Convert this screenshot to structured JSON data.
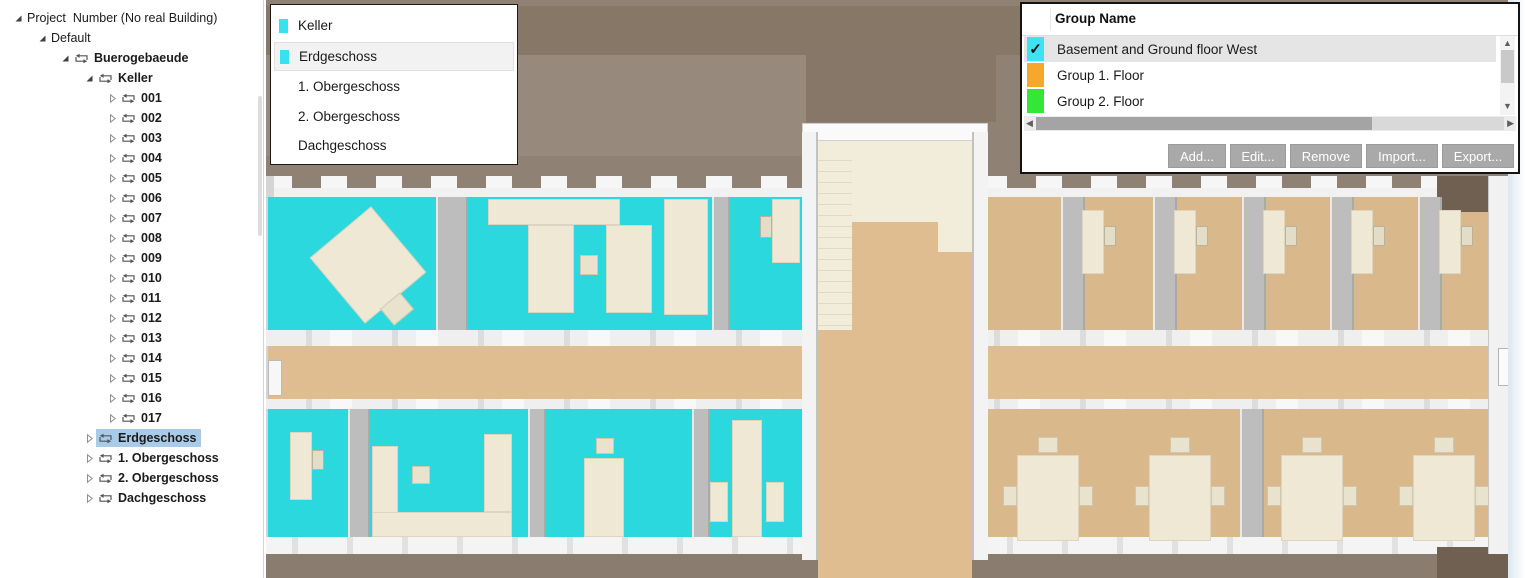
{
  "tree": {
    "items": [
      {
        "label": "Project  Number (No real Building)",
        "level": 0,
        "expanded": true,
        "swap": false,
        "bold": false,
        "selected": false
      },
      {
        "label": "Default",
        "level": 1,
        "expanded": true,
        "swap": false,
        "bold": false,
        "selected": false
      },
      {
        "label": "Buerogebaeude",
        "level": 2,
        "expanded": true,
        "swap": true,
        "bold": true,
        "selected": false
      },
      {
        "label": "Keller",
        "level": 3,
        "expanded": true,
        "swap": true,
        "bold": true,
        "selected": false
      },
      {
        "label": "001",
        "level": 4,
        "expanded": false,
        "swap": true,
        "bold": true,
        "selected": false
      },
      {
        "label": "002",
        "level": 4,
        "expanded": false,
        "swap": true,
        "bold": true,
        "selected": false
      },
      {
        "label": "003",
        "level": 4,
        "expanded": false,
        "swap": true,
        "bold": true,
        "selected": false
      },
      {
        "label": "004",
        "level": 4,
        "expanded": false,
        "swap": true,
        "bold": true,
        "selected": false
      },
      {
        "label": "005",
        "level": 4,
        "expanded": false,
        "swap": true,
        "bold": true,
        "selected": false
      },
      {
        "label": "006",
        "level": 4,
        "expanded": false,
        "swap": true,
        "bold": true,
        "selected": false
      },
      {
        "label": "007",
        "level": 4,
        "expanded": false,
        "swap": true,
        "bold": true,
        "selected": false
      },
      {
        "label": "008",
        "level": 4,
        "expanded": false,
        "swap": true,
        "bold": true,
        "selected": false
      },
      {
        "label": "009",
        "level": 4,
        "expanded": false,
        "swap": true,
        "bold": true,
        "selected": false
      },
      {
        "label": "010",
        "level": 4,
        "expanded": false,
        "swap": true,
        "bold": true,
        "selected": false
      },
      {
        "label": "011",
        "level": 4,
        "expanded": false,
        "swap": true,
        "bold": true,
        "selected": false
      },
      {
        "label": "012",
        "level": 4,
        "expanded": false,
        "swap": true,
        "bold": true,
        "selected": false
      },
      {
        "label": "013",
        "level": 4,
        "expanded": false,
        "swap": true,
        "bold": true,
        "selected": false
      },
      {
        "label": "014",
        "level": 4,
        "expanded": false,
        "swap": true,
        "bold": true,
        "selected": false
      },
      {
        "label": "015",
        "level": 4,
        "expanded": false,
        "swap": true,
        "bold": true,
        "selected": false
      },
      {
        "label": "016",
        "level": 4,
        "expanded": false,
        "swap": true,
        "bold": true,
        "selected": false
      },
      {
        "label": "017",
        "level": 4,
        "expanded": false,
        "swap": true,
        "bold": true,
        "selected": false
      },
      {
        "label": "Erdgeschoss",
        "level": 3,
        "expanded": false,
        "swap": true,
        "bold": true,
        "selected": true
      },
      {
        "label": "1. Obergeschoss",
        "level": 3,
        "expanded": false,
        "swap": true,
        "bold": true,
        "selected": false
      },
      {
        "label": "2. Obergeschoss",
        "level": 3,
        "expanded": false,
        "swap": true,
        "bold": true,
        "selected": false
      },
      {
        "label": "Dachgeschoss",
        "level": 3,
        "expanded": false,
        "swap": true,
        "bold": true,
        "selected": false
      }
    ]
  },
  "legend": {
    "items": [
      {
        "label": "Keller",
        "chip_color": "#38E1EF",
        "selected": false
      },
      {
        "label": "Erdgeschoss",
        "chip_color": "#38E1EF",
        "selected": true
      },
      {
        "label": "1. Obergeschoss",
        "chip_color": null,
        "selected": false
      },
      {
        "label": "2. Obergeschoss",
        "chip_color": null,
        "selected": false
      },
      {
        "label": "Dachgeschoss",
        "chip_color": null,
        "selected": false
      }
    ]
  },
  "groups": {
    "header": "Group Name",
    "items": [
      {
        "label": "Basement and Ground floor West",
        "color": "#3FE2F2",
        "checked": true,
        "selected": true
      },
      {
        "label": "Group 1. Floor",
        "color": "#F5A72E",
        "checked": false,
        "selected": false
      },
      {
        "label": "Group 2. Floor",
        "color": "#36E636",
        "checked": false,
        "selected": false
      }
    ],
    "check_glyph": "✓",
    "buttons": [
      {
        "id": "add",
        "label": "Add...",
        "width": 58
      },
      {
        "id": "edit",
        "label": "Edit...",
        "width": 56
      },
      {
        "id": "remove",
        "label": "Remove",
        "width": 72
      },
      {
        "id": "import",
        "label": "Import...",
        "width": 72
      },
      {
        "id": "export",
        "label": "Export...",
        "width": 72
      }
    ],
    "scroll_arrows": {
      "up": "▲",
      "down": "▼",
      "left": "◀",
      "right": "▶"
    }
  },
  "canvas": {
    "colors": {
      "background": "#8F8174",
      "band_dark": "#867767",
      "band_mid": "#97897B",
      "band_stair": "#877769",
      "exterior_bottom": "#8A7C6E",
      "exterior_dark": "#6F6051",
      "cyan_floor": "#2BD8DE",
      "tan_floor": "#D9B88C",
      "corridor": "#DFBD90",
      "wall_white": "#F1F1F1",
      "wall_gray": "#BDBDBD",
      "desk": "#EFE8D4",
      "stair_cream": "#F2EDDA",
      "edge_strip": "#DCE7F0",
      "selection": "#A9CBE8",
      "legend_highlight": "#F2F2F2",
      "row_highlight": "#E5E5E5",
      "button_bg": "#A9A9A9"
    }
  }
}
